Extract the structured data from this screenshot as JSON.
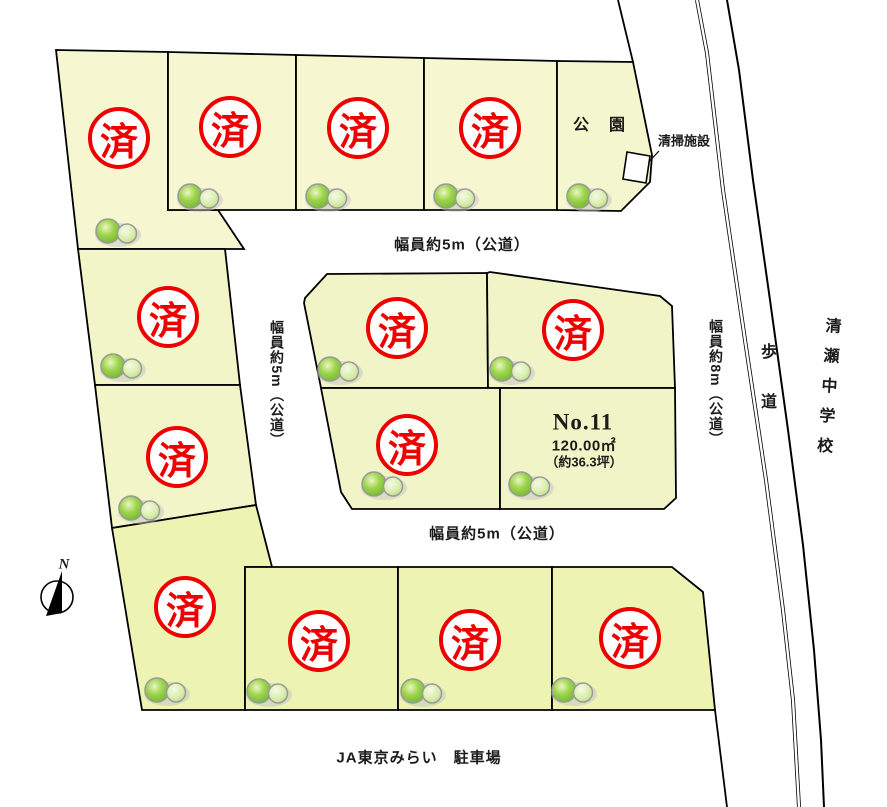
{
  "stamp": {
    "label": "済"
  },
  "compass": {
    "label": "N"
  },
  "roads": {
    "north_road": "幅員約5m（公道）",
    "south_road": "幅員約5m（公道）",
    "west_road": "幅員約5m（公道）",
    "east_road": "幅員約8m（公道）",
    "sidewalk": "歩道"
  },
  "places": {
    "park": "公　園",
    "cleaning_facility": "清掃施設",
    "school": "清瀬中学校",
    "parking": "JA東京みらい　駐車場"
  },
  "featured_lot": {
    "number": "No.11",
    "area_m2": "120.00㎡",
    "area_tsubo": "（約36.3坪）"
  },
  "colors": {
    "stamp_red": "#ee0000",
    "lot_fill_top": "#f6f6d0",
    "lot_fill_left": "#f1f5c8",
    "lot_fill_center": "#f0f4c6",
    "lot_fill_south": "#edf3b2"
  }
}
